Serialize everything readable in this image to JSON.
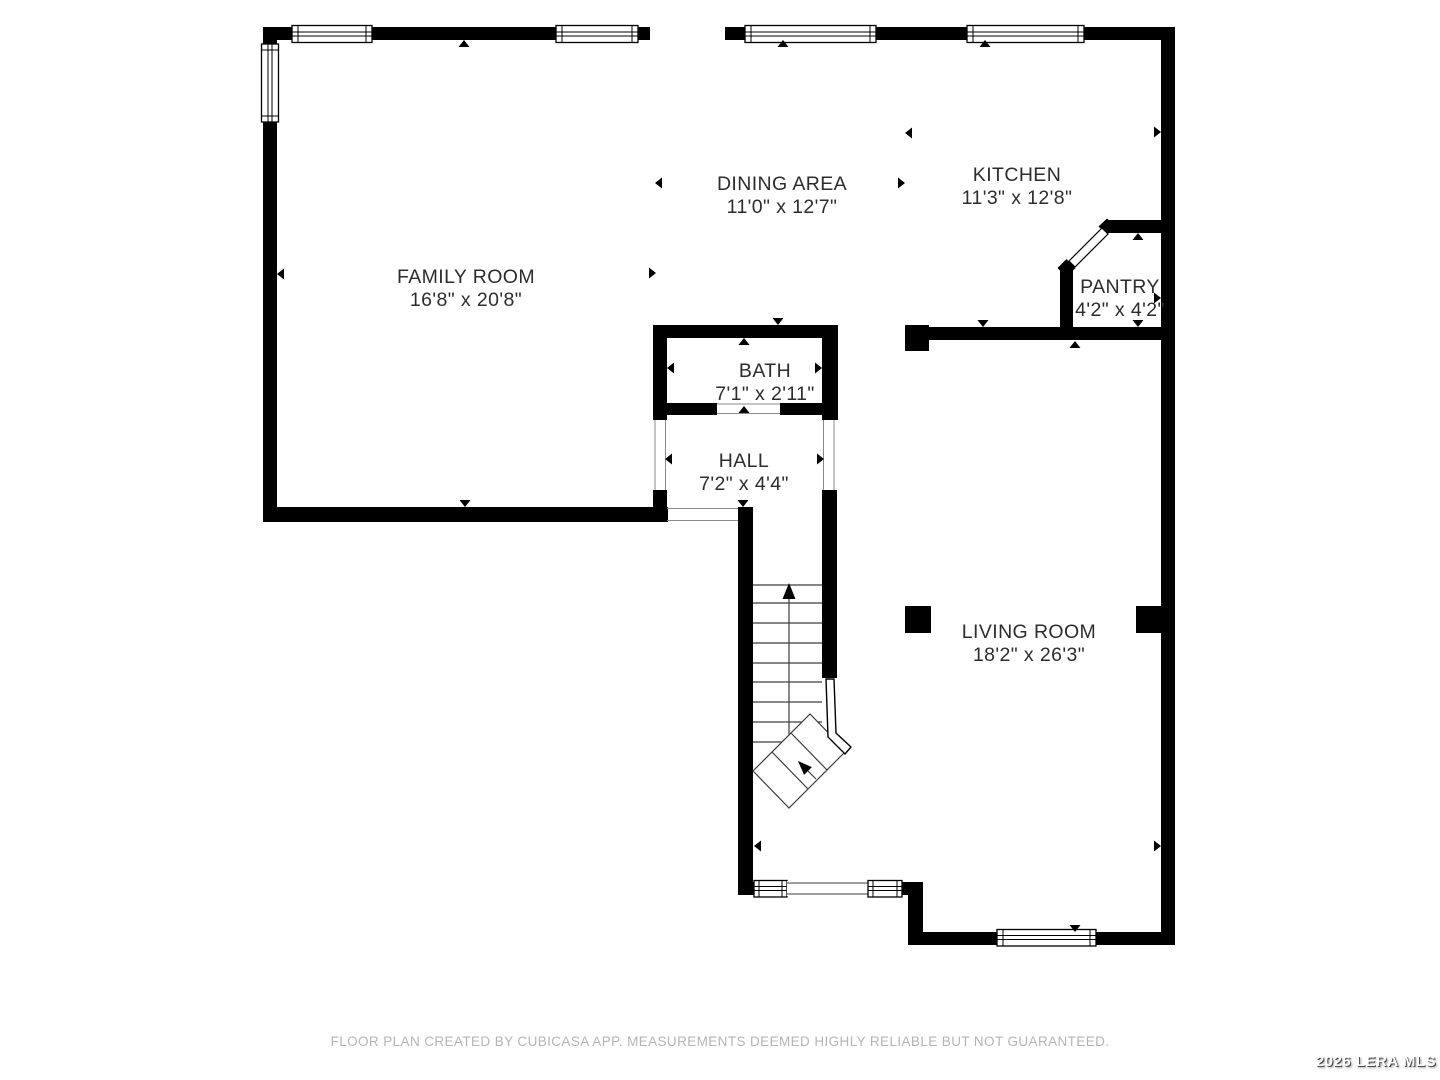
{
  "floor_plan": {
    "rooms": [
      {
        "name": "FAMILY ROOM",
        "dims": "16'8\" x 20'8\""
      },
      {
        "name": "DINING AREA",
        "dims": "11'0\" x 12'7\""
      },
      {
        "name": "KITCHEN",
        "dims": "11'3\" x 12'8\""
      },
      {
        "name": "PANTRY",
        "dims": "4'2\" x 4'2\""
      },
      {
        "name": "BATH",
        "dims": "7'1\" x 2'11\""
      },
      {
        "name": "HALL",
        "dims": "7'2\" x 4'4\""
      },
      {
        "name": "LIVING ROOM",
        "dims": "18'2\" x 26'3\""
      }
    ]
  },
  "footer": {
    "disclaimer": "FLOOR PLAN CREATED BY CUBICASA APP. MEASUREMENTS DEEMED HIGHLY RELIABLE BUT NOT GUARANTEED."
  },
  "watermark": {
    "text": "2026 LERA MLS"
  },
  "colors": {
    "background": "#ffffff",
    "wall": "#000000",
    "room_text": "#2d2d2d",
    "footer_text": "#b5b5b5",
    "watermark_text": "#ffffff",
    "watermark_shadow": "#4a4a4a"
  }
}
